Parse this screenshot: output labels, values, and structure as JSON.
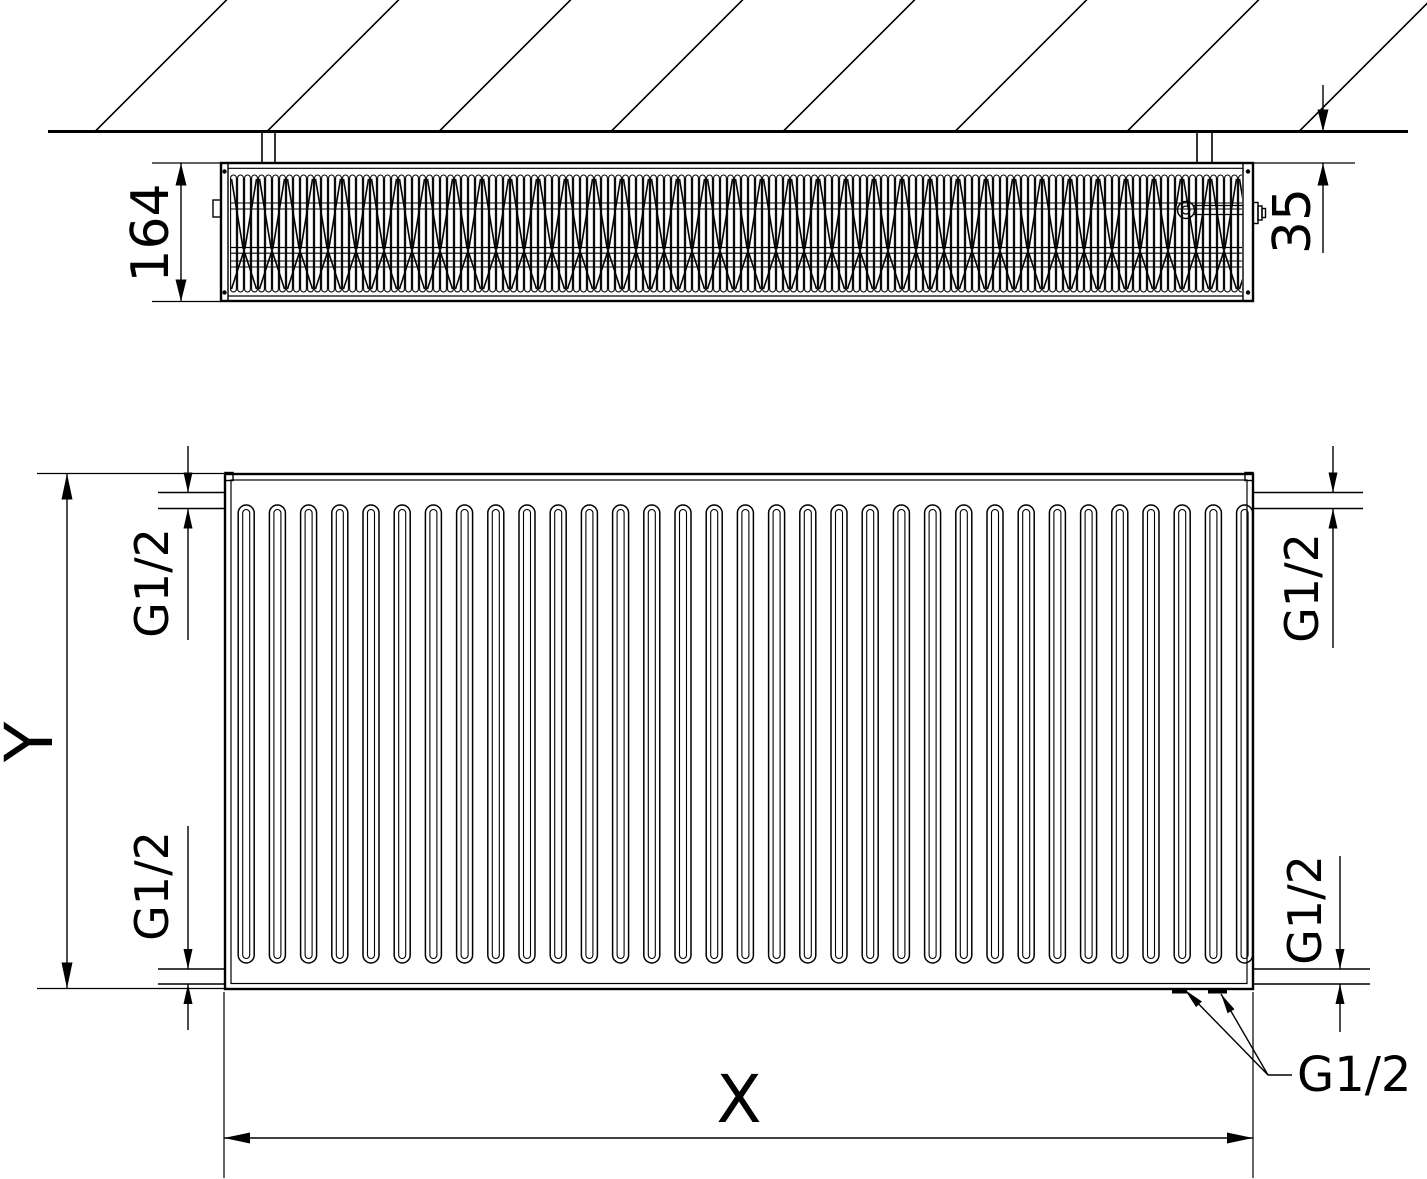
{
  "figure": {
    "type": "technical-dimension-drawing",
    "subject": "panel radiator shown in wall-mounted top section view and front view",
    "views": [
      "top-section-at-wall",
      "front"
    ],
    "counts": {
      "front_grooves": 33,
      "hatch_lines": 8
    }
  },
  "labels": {
    "depth": "164",
    "wall_gap": "35",
    "height": "Y",
    "length": "X",
    "thread": "G1/2"
  },
  "colors": {
    "line": "#000000",
    "background": "#ffffff"
  }
}
